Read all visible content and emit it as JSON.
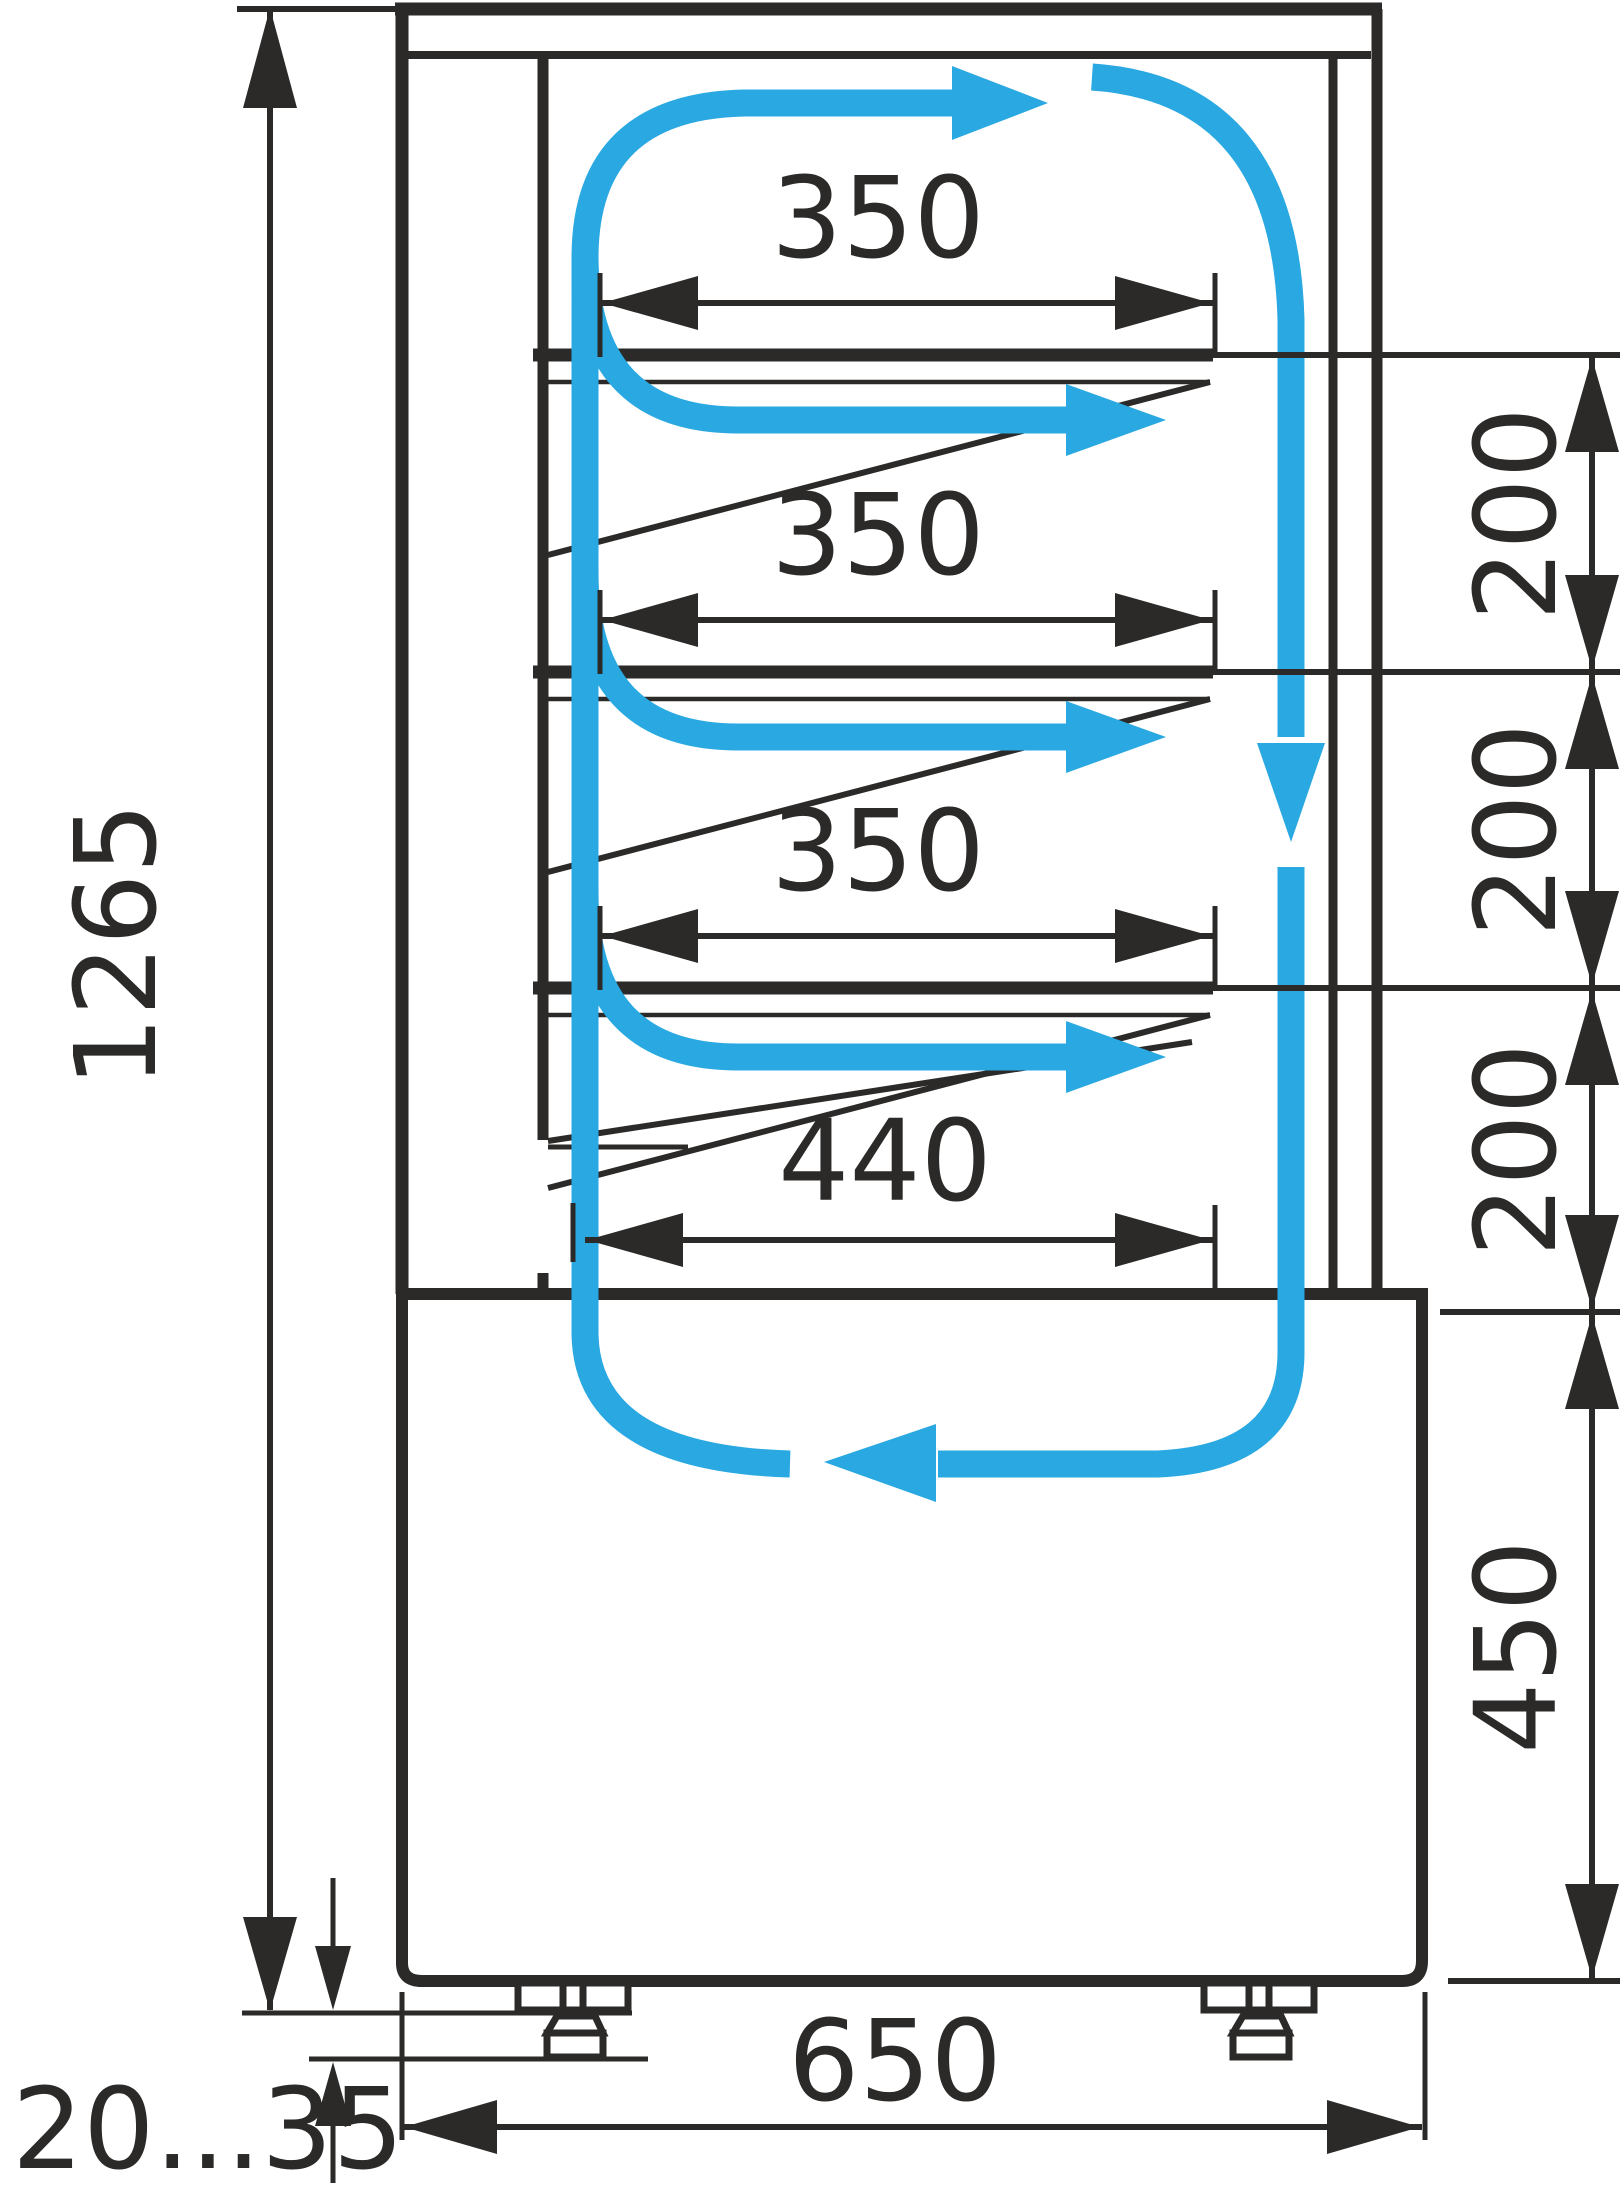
{
  "drawing": {
    "type": "technical-dimension-drawing",
    "subject": "refrigerated confectionery display case - side section with air circulation",
    "units": "mm",
    "colors": {
      "line": "#2B2A29",
      "airflow": "#29A8E1",
      "background": "#FFFFFF"
    },
    "dimensions": {
      "overall_height": "1265",
      "shelf_width_1": "350",
      "shelf_width_2": "350",
      "shelf_width_3": "350",
      "bottom_shelf_width": "440",
      "shelf_gap_1": "200",
      "shelf_gap_2": "200",
      "shelf_gap_3": "200",
      "base_height": "450",
      "base_depth": "650",
      "feet_adjustment_range": "20...35"
    },
    "airflow_icons": {
      "description": "blue arrows showing cold air loop: up rear duct, over shelves, down front glass air curtain, return through base"
    }
  }
}
